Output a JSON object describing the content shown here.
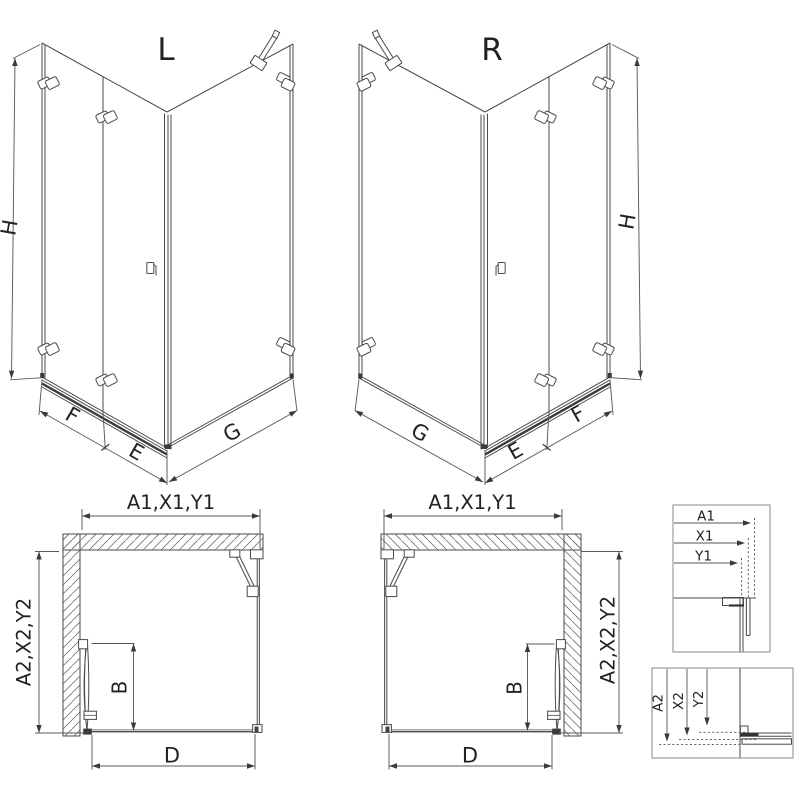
{
  "canvas": {
    "background": "#ffffff",
    "line_color": "#4a4a4a",
    "dim_line_color": "#5a5a5a",
    "text_color": "#222222",
    "dark_fitting_color": "#3a3a3a"
  },
  "iso_left": {
    "variant": "L",
    "dim_height": "H",
    "dim_front_fixed": "F",
    "dim_front_door": "E",
    "dim_side": "G"
  },
  "iso_right": {
    "variant": "R",
    "dim_height": "H",
    "dim_front_fixed": "F",
    "dim_front_door": "E",
    "dim_side": "G"
  },
  "plan_left": {
    "dim_top": "A1,X1,Y1",
    "dim_side": "A2,X2,Y2",
    "dim_door": "B",
    "dim_front": "D"
  },
  "plan_right": {
    "dim_top": "A1,X1,Y1",
    "dim_side": "A2,X2,Y2",
    "dim_door": "B",
    "dim_front": "D"
  },
  "detail_width": {
    "labels": [
      "A1",
      "X1",
      "Y1"
    ]
  },
  "detail_depth": {
    "labels": [
      "A2",
      "X2",
      "Y2"
    ]
  }
}
